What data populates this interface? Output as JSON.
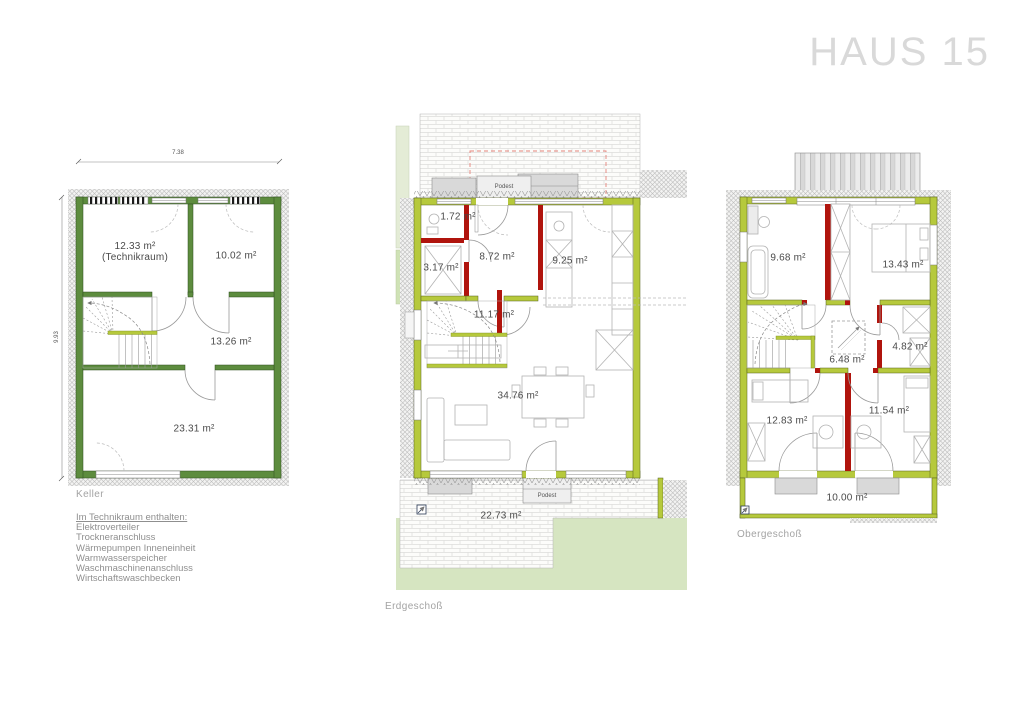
{
  "title": "HAUS 15",
  "floors": {
    "keller": {
      "caption": "Keller",
      "dimensions": {
        "width": "7.38",
        "depth": "9.93"
      },
      "rooms": [
        {
          "id": "technikraum",
          "area": "12.33 m²",
          "note": "(Technikraum)"
        },
        {
          "id": "kellerraum-2",
          "area": "10.02 m²"
        },
        {
          "id": "kellerraum-3",
          "area": "13.26 m²"
        },
        {
          "id": "kellerraum-4",
          "area": "23.31 m²"
        }
      ],
      "notes": {
        "heading": "Im Technikraum enthalten:",
        "items": [
          "Elektroverteiler",
          "Trockneranschluss",
          "Wärmepumpen Inneneinheit",
          "Warmwasserspeicher",
          "Waschmaschinenanschluss",
          "Wirtschaftswaschbecken"
        ]
      }
    },
    "erdgeschoss": {
      "caption": "Erdgeschoß",
      "podest": "Podest",
      "rooms": [
        {
          "id": "wc",
          "area": "1.72 m²"
        },
        {
          "id": "abstellraum",
          "area": "3.17 m²"
        },
        {
          "id": "diele",
          "area": "8.72 m²"
        },
        {
          "id": "kueche",
          "area": "9.25 m²"
        },
        {
          "id": "flur",
          "area": "11.17 m²"
        },
        {
          "id": "wohnen-essen",
          "area": "34.76 m²"
        },
        {
          "id": "terrasse",
          "area": "22.73 m²"
        }
      ]
    },
    "obergeschoss": {
      "caption": "Obergeschoß",
      "rooms": [
        {
          "id": "bad",
          "area": "9.68 m²"
        },
        {
          "id": "schlafzimmer",
          "area": "13.43 m²"
        },
        {
          "id": "flur",
          "area": "6.48 m²"
        },
        {
          "id": "ankleide",
          "area": "4.82 m²"
        },
        {
          "id": "zimmer-2",
          "area": "12.83 m²"
        },
        {
          "id": "zimmer-3",
          "area": "11.54 m²"
        },
        {
          "id": "balkon",
          "area": "10.00 m²"
        }
      ]
    }
  },
  "colors": {
    "exterior_wall": "#b6c93c",
    "basement_wall": "#5d8c3e",
    "interior_wall": "#b0140d",
    "lawn": "#d6e5c1",
    "title_gray": "#d9d9d9"
  }
}
